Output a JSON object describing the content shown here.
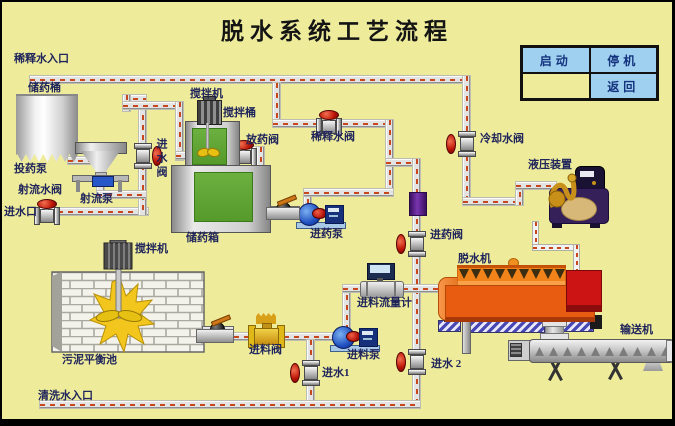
{
  "title": "脱水系统工艺流程",
  "panel": {
    "start": "启动",
    "stop": "停机",
    "back": "返回"
  },
  "labels": {
    "dilution_inlet": "稀释水入口",
    "chem_barrel": "储药桶",
    "dosing_pump": "投药泵",
    "jet_water_valve": "射流水阀",
    "water_inlet": "进水口",
    "jet_pump": "射流泵",
    "inlet_valve": "进水阀",
    "mixer_top": "搅拌机",
    "mixing_barrel": "搅拌桶",
    "release_valve": "放药阀",
    "dilution_valve": "稀释水阀",
    "chem_tank": "储药箱",
    "chem_pump": "进药泵",
    "chem_feed_valve": "进药阀",
    "cooling_valve": "冷却水阀",
    "hydraulic_unit": "液压装置",
    "dewaterer": "脱水机",
    "mixer_pool": "搅拌机",
    "balance_pool": "污泥平衡池",
    "feed_valve": "进料阀",
    "feed_pump": "进料泵",
    "water_inlet_1": "进水1",
    "water_inlet_2": "进水 2",
    "feed_flow_meter": "进料流量计",
    "wash_inlet": "清洗水入口",
    "conveyor": "输送机"
  },
  "colors": {
    "background": "#EEEC9B",
    "pipe_dash": "#C8481E",
    "button_bg": "#9FD0EF",
    "button_text": "#14337F",
    "machine_orange": "#E85C12",
    "alarm_red": "#CC1414",
    "tank_green": "#5FA534",
    "hydraulic_purple": "#35205A"
  }
}
